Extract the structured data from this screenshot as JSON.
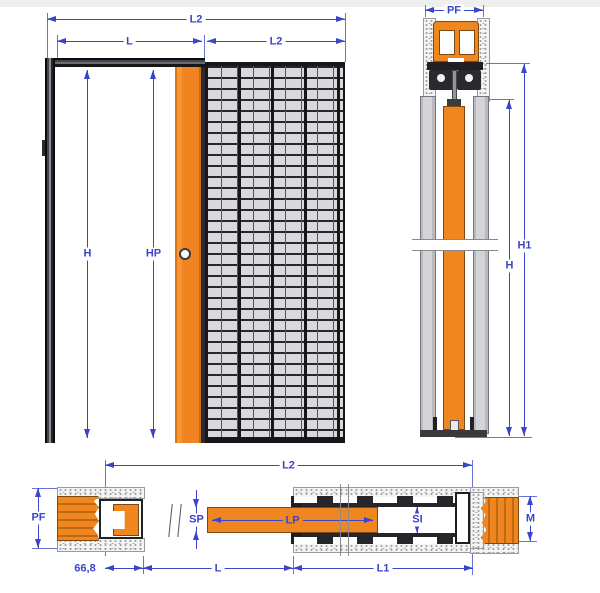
{
  "labels": {
    "front": {
      "overall_width": "L2",
      "passage_width": "L",
      "pocket_width": "L2",
      "opening_height": "H",
      "panel_height": "HP"
    },
    "section_vertical": {
      "frame_depth": "PF",
      "overall_height": "H1",
      "opening_height": "H"
    },
    "section_horizontal": {
      "overall_width": "L2",
      "frame_depth": "PF",
      "jamb_offset": "66,8",
      "panel_thickness": "SP",
      "panel_width": "LP",
      "passage_width": "L",
      "pocket_interior": "SI",
      "post_depth": "M",
      "pocket_length": "L1"
    }
  },
  "colors": {
    "dimension_blue": "#3a46c8",
    "panel_orange": "#f0861f",
    "mesh_gray": "#d9d9dc",
    "frame_dark": "#1c1c20",
    "plasterboard_gray": "#cbccd0",
    "background": "#ffffff"
  }
}
